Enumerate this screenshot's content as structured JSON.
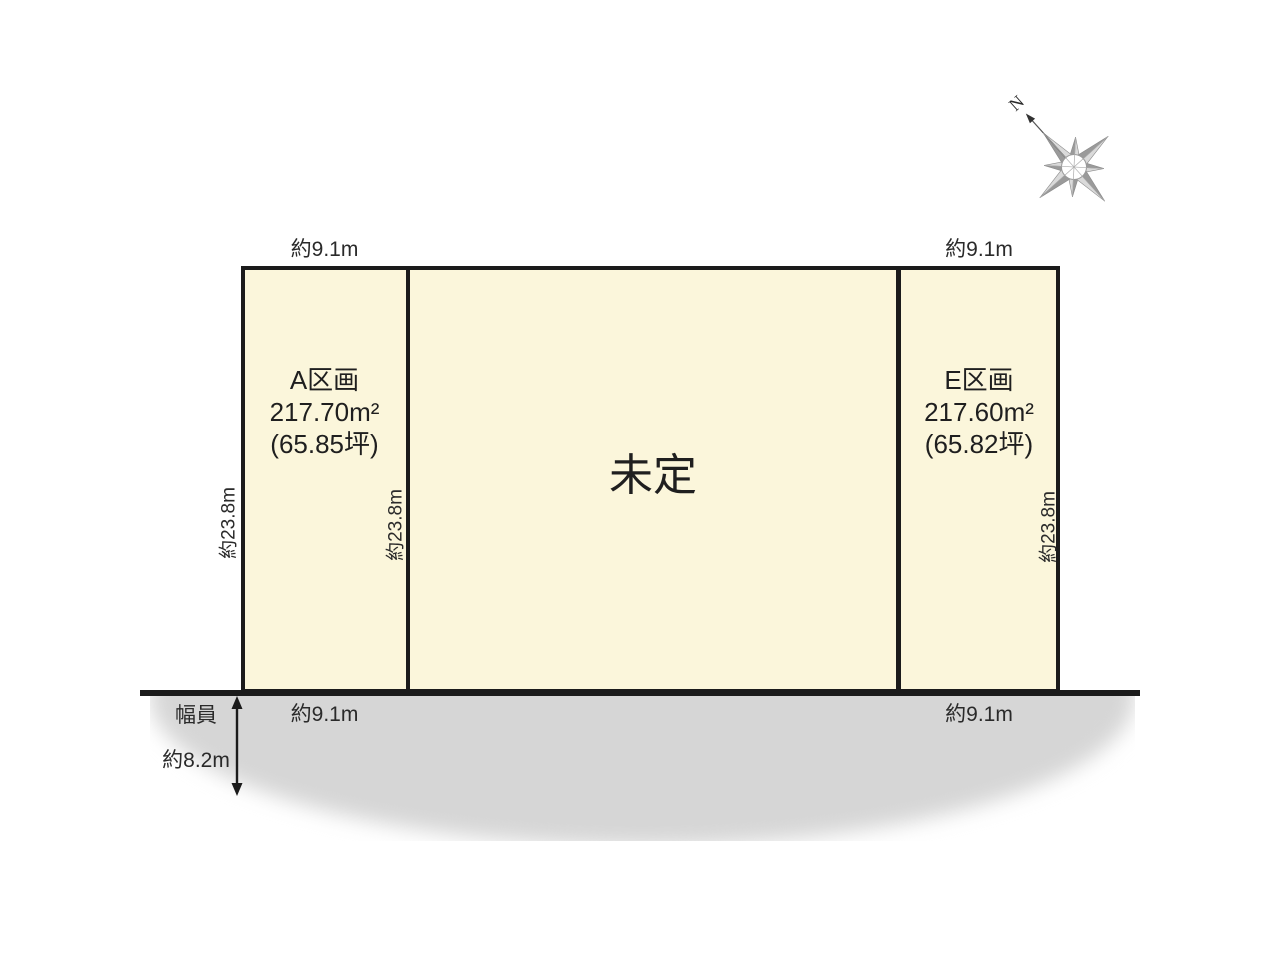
{
  "compass": {
    "north_label": "N"
  },
  "plots": [
    {
      "id": "A",
      "name": "A区画",
      "area_m2": "217.70m²",
      "area_tsubo": "(65.85坪)"
    },
    {
      "id": "center",
      "name": "未定"
    },
    {
      "id": "E",
      "name": "E区画",
      "area_m2": "217.60m²",
      "area_tsubo": "(65.82坪)"
    }
  ],
  "dimensions": {
    "top_a": "約9.1m",
    "top_e": "約9.1m",
    "bottom_a": "約9.1m",
    "bottom_e": "約9.1m",
    "left_side": "約23.8m",
    "middle_side": "約23.8m",
    "right_side": "約23.8m"
  },
  "road": {
    "width_label_line1": "幅員",
    "width_label_line2": "約8.2m"
  },
  "colors": {
    "plot_fill": "#fbf6db",
    "border": "#1b1b1b",
    "road_gray": "#d6d6d6"
  }
}
